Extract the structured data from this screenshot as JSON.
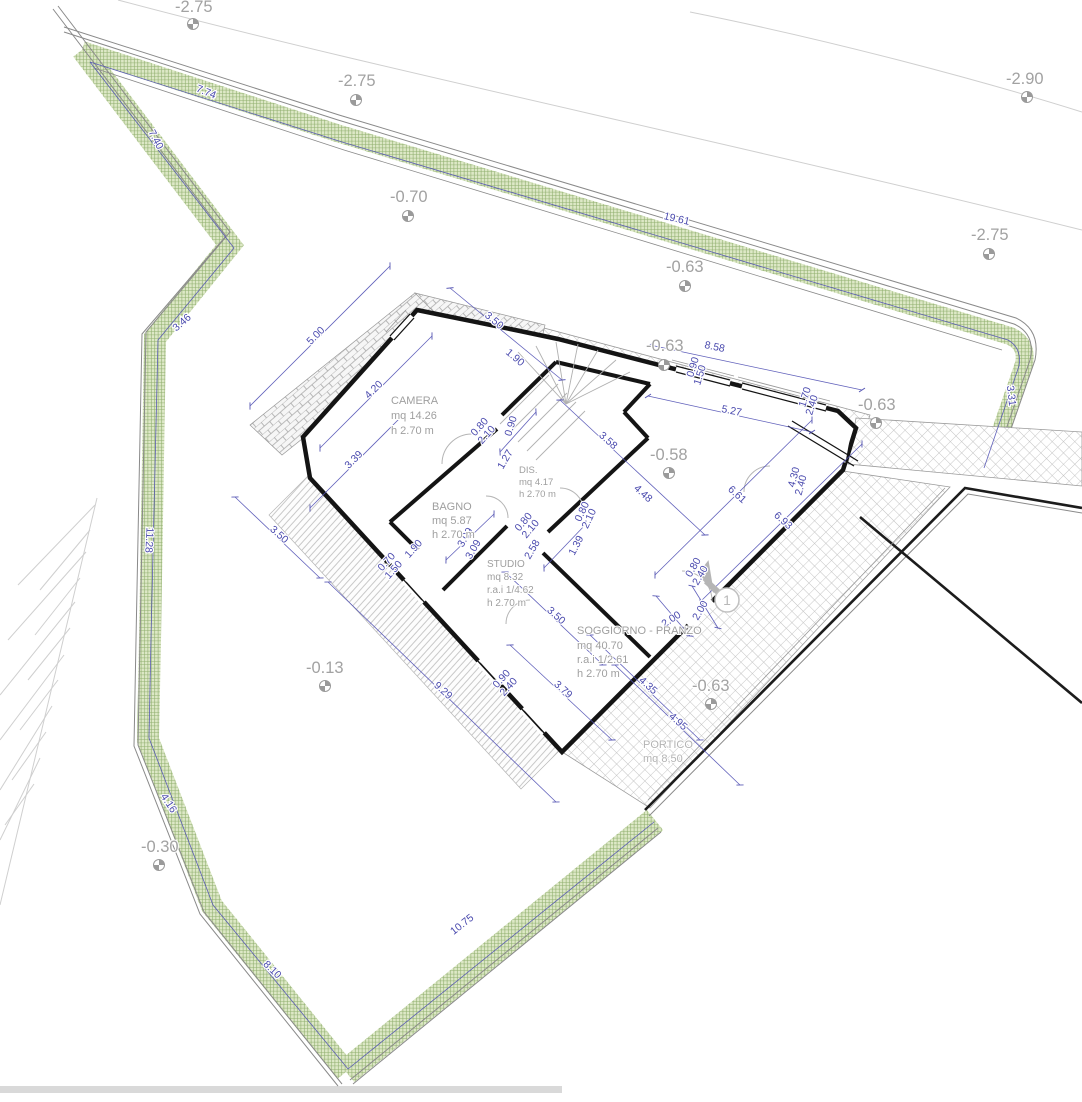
{
  "drawing": {
    "kind": "floor-plan-site-plan",
    "language": "it"
  },
  "colors": {
    "dimension_blue": "#4a4aae",
    "room_label_gray": "#9f9f9f",
    "elevation_gray": "#a2a2a2",
    "vegetation_green": "#8fae6d",
    "wall_black": "#141414",
    "hatch_gray": "#c2c2c2"
  },
  "rooms": [
    {
      "name": "CAMERA",
      "area": "mq 14.26",
      "height": "h 2.70 m"
    },
    {
      "name": "DIS.",
      "area": "mq 4.17",
      "height": "h 2.70 m"
    },
    {
      "name": "BAGNO",
      "area": "mq 5.87",
      "height": "h 2.70 m"
    },
    {
      "name": "STUDIO",
      "area": "mq 8.32",
      "rai": "r.a.i 1/4.62",
      "height": "h 2.70 m"
    },
    {
      "name": "SOGGIORNO - PRANZO",
      "area": "mq 40.70",
      "rai": "r.a.i 1/2.61",
      "height": "h 2.70 m"
    },
    {
      "name": "PORTICO",
      "area": "mq 8,50"
    }
  ],
  "elevation_markers": [
    "-2.75",
    "-2.75",
    "-2.90",
    "-2.75",
    "-0.70",
    "-0.63",
    "-0.63",
    "-0.63",
    "-0.58",
    "-0.63",
    "-0.13",
    "-0.30"
  ],
  "site_dimensions": [
    "7.74",
    "19.61",
    "3.46",
    "7.40",
    "11.28",
    "4.16",
    "8.10",
    "10.75",
    "3.31"
  ],
  "building_dimensions": [
    "5.00",
    "3.50",
    "1.90",
    "8.58",
    "5.27",
    "4.20",
    "3.39",
    "0.90",
    "1.27",
    "3.58",
    "4.48",
    "6.61",
    "6.93",
    "2.58",
    "1.39",
    "3.09",
    "3.09",
    "1.90",
    "3.50",
    "9.29",
    "3.79",
    "3.50",
    "2.00",
    "2.00",
    "4.35",
    "4.95"
  ],
  "opening_dimensions": [
    "0.80",
    "2.10",
    "0.80",
    "2.10",
    "0.80",
    "2.10",
    "0.90",
    "1.50",
    "1.70",
    "2.40",
    "4.30",
    "2.40",
    "0.80",
    "2.40",
    "0.70",
    "1.50",
    "0.90",
    "2.40"
  ],
  "markers": {
    "step_number": "1"
  }
}
